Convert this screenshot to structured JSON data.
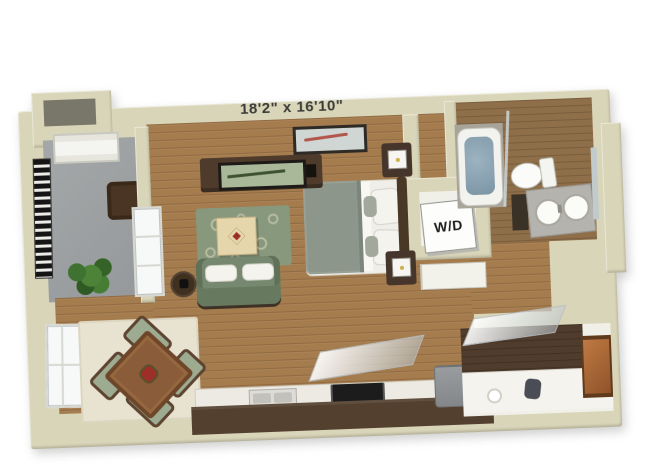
{
  "floorplan": {
    "dimensions_label": "18'2\" x 16'10\"",
    "washer_dryer_label": "W/D",
    "rooms": [
      "balcony",
      "living-area",
      "sleeping-area",
      "dining-nook",
      "kitchen",
      "bathroom",
      "entry-den",
      "washer-dryer-closet"
    ],
    "furniture": [
      "balcony-chair",
      "potted-plant",
      "balcony-door",
      "tv-console",
      "wall-art",
      "area-rug",
      "coffee-table",
      "sofa",
      "side-table",
      "bed",
      "nightstands",
      "cube-lamps",
      "dining-table",
      "dining-chairs",
      "kitchen-sink",
      "cooktop",
      "refrigerator",
      "bathtub",
      "shower-glass",
      "toilet",
      "double-vanity",
      "copper-shelf"
    ],
    "colors": {
      "background": "#ffffff",
      "wall": "#d9d5b9",
      "wood_floor": "#a57c4e",
      "balcony_floor": "#9b9fa0",
      "rug_living": "#87987d",
      "rug_dining": "#e8e2d0",
      "sofa_green": "#76886f",
      "bed_blanket": "#8d968b",
      "kitchen_base": "#53402e",
      "tub_water": "#87a0ae",
      "accent_red": "#9e2f28",
      "copper": "#b06a3a",
      "railing_black": "#141414"
    }
  }
}
